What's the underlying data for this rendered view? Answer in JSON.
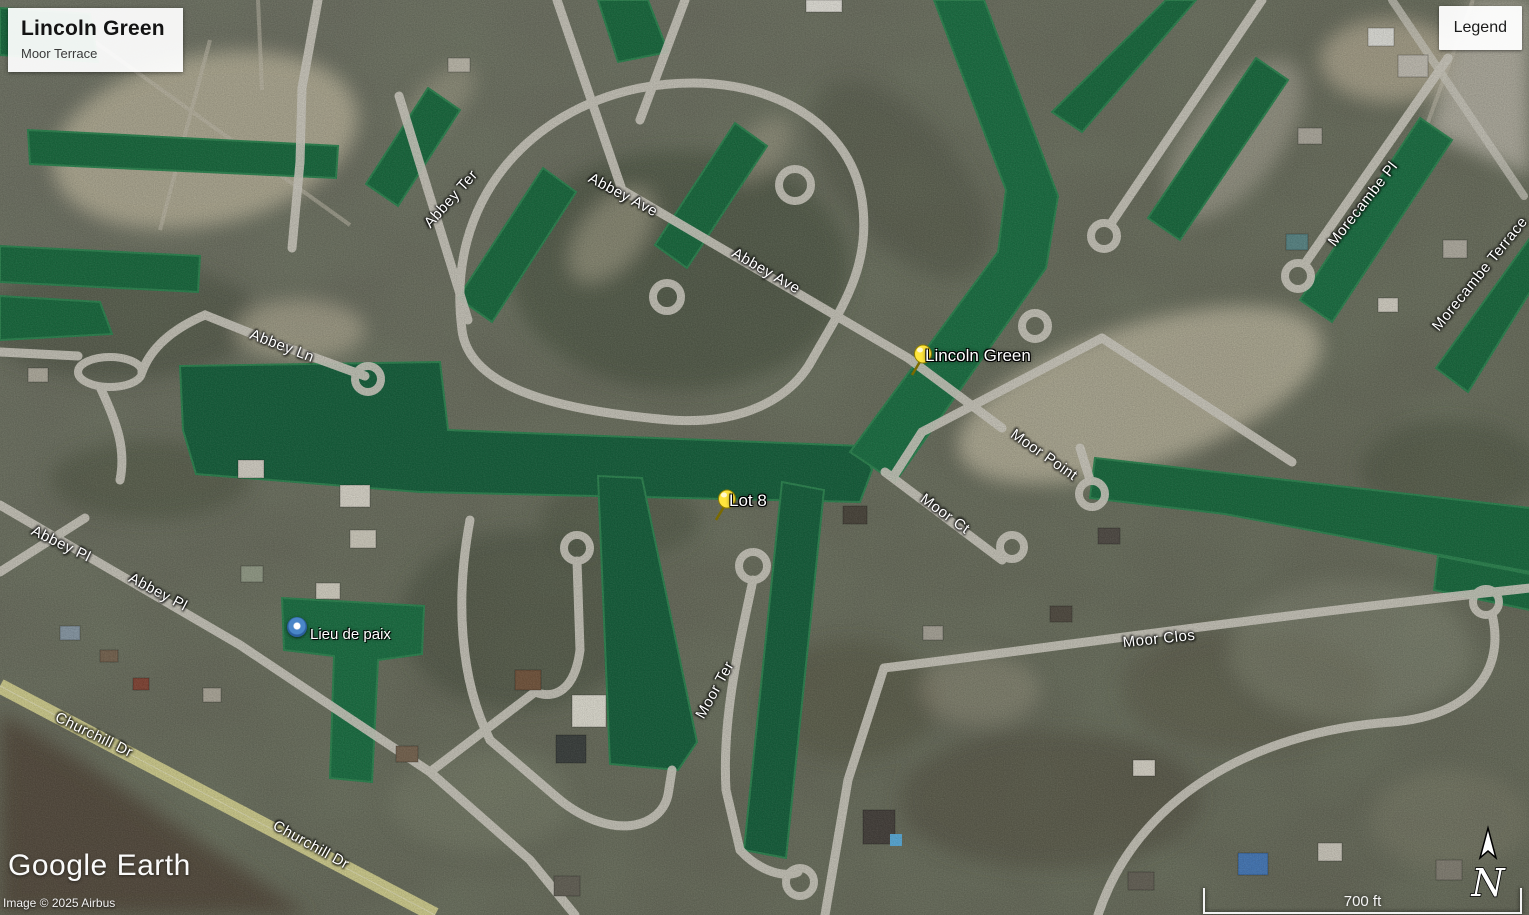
{
  "window": {
    "app": "Google Earth"
  },
  "overlay": {
    "title_card": {
      "title": "Lincoln Green",
      "subtitle": "Moor Terrace"
    },
    "legend_button": {
      "label": "Legend"
    },
    "logo": {
      "text": "Google Earth"
    },
    "attribution": {
      "text": "Image © 2025 Airbus"
    },
    "scale_bar": {
      "label": "700 ft"
    },
    "compass": {
      "label": "N"
    }
  },
  "map": {
    "placemarks": [
      {
        "label": "Lincoln Green",
        "icon": "yellow-pushpin"
      },
      {
        "label": "Lot 8",
        "icon": "yellow-pushpin"
      }
    ],
    "poi": {
      "label": "Lieu de paix",
      "icon": "blue-dot"
    },
    "street_labels": [
      {
        "label": "Abbey Ter"
      },
      {
        "label": "Abbey Ave"
      },
      {
        "label": "Abbey Ave"
      },
      {
        "label": "Abbey Ln"
      },
      {
        "label": "Abbey Pl"
      },
      {
        "label": "Abbey Pl"
      },
      {
        "label": "Churchill Dr"
      },
      {
        "label": "Churchill Dr"
      },
      {
        "label": "Moor Ter"
      },
      {
        "label": "Moor Point"
      },
      {
        "label": "Moor Ct"
      },
      {
        "label": "Moor Clos"
      },
      {
        "label": "Morecambe Pl"
      },
      {
        "label": "Morecambe Terrace"
      }
    ],
    "colors": {
      "canal_water": "#1b6f42",
      "terrain": "#6f7260",
      "road": "#d6d3c8",
      "churchill_road": "#d8d594",
      "pushpin": "#ffe53d"
    }
  }
}
